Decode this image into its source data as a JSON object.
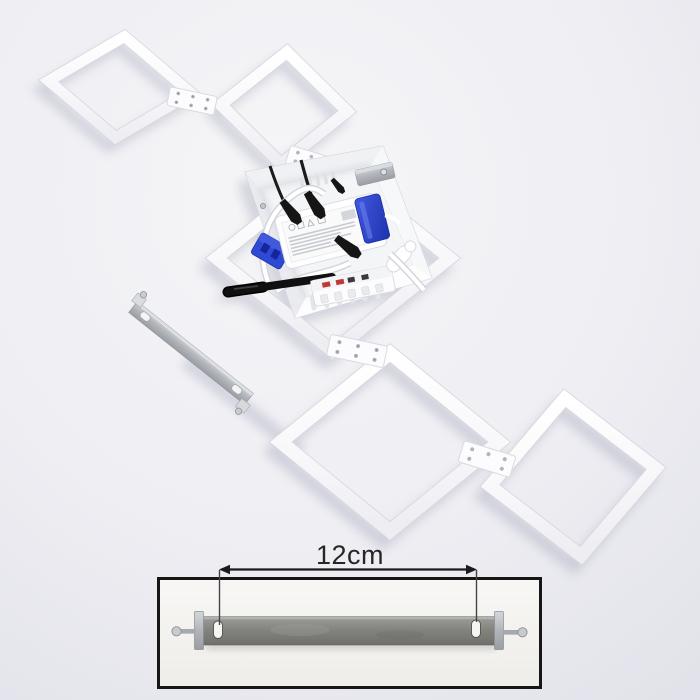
{
  "photo": {
    "type": "product-photo",
    "subject": "white-square-frames-ceiling-light-disassembled-rear-view",
    "dimension_label": "12cm"
  },
  "colors": {
    "background": "#ececf1",
    "frame_white": "#fbfbfd",
    "connector_blue": "#2e49d4",
    "cable_black": "#141414",
    "bracket_silver": "#b9bcc0",
    "inset_bracket_gray": "#86868",
    "inset_border": "#161616",
    "dimension_text": "#262626"
  }
}
